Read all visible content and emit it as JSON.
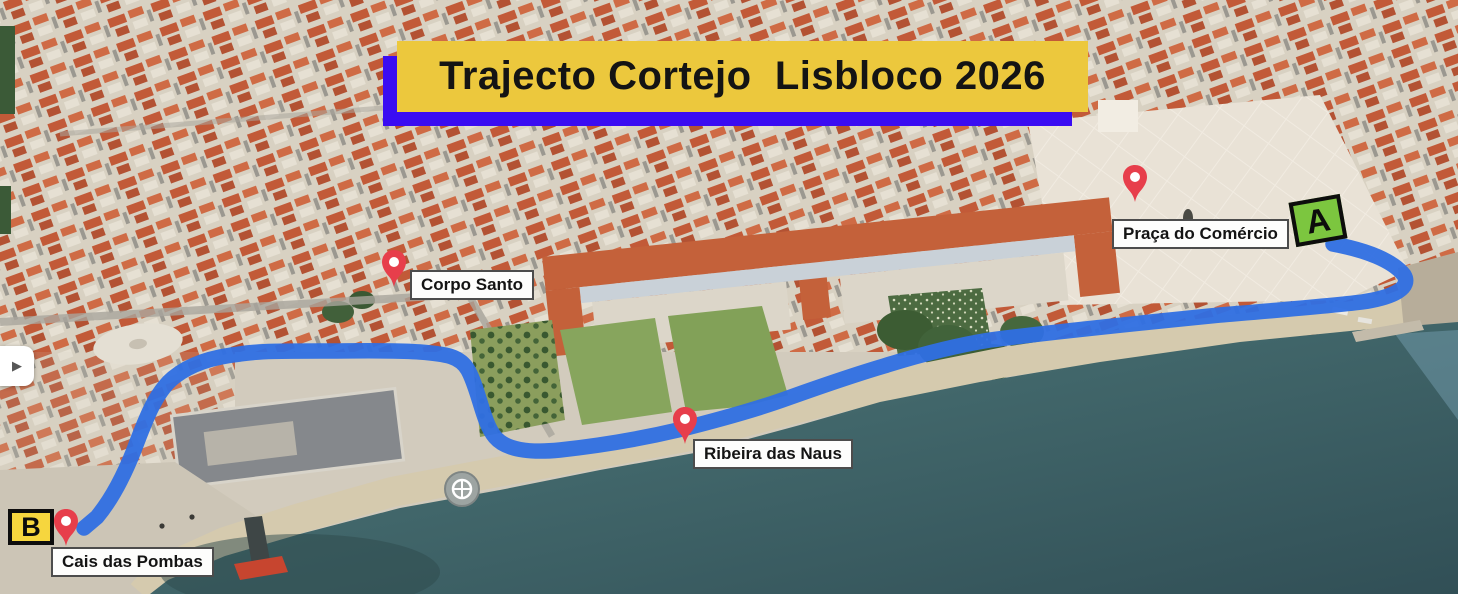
{
  "title": {
    "text": "Trajecto Cortejo  Lisbloco 2026"
  },
  "route": {
    "start_label": "A",
    "end_label": "B",
    "color": "#2f6fe3",
    "start_place": "Praça do Comércio",
    "end_place": "Cais das Pombas"
  },
  "places": [
    {
      "name": "Praça do Comércio"
    },
    {
      "name": "Corpo Santo"
    },
    {
      "name": "Ribeira das Naus"
    },
    {
      "name": "Cais das Pombas"
    }
  ],
  "controls": {
    "expand_glyph": "▶"
  },
  "colors": {
    "banner_fill": "#ecc83d",
    "banner_shadow": "#3a0cf2",
    "marker_a_fill": "#7cc63f",
    "marker_b_fill": "#f6d63e",
    "pin_red": "#e73e4b",
    "route_blue": "#2f6fe3",
    "water_teal": "#3f6165",
    "roof_orange": "#c25a38"
  }
}
